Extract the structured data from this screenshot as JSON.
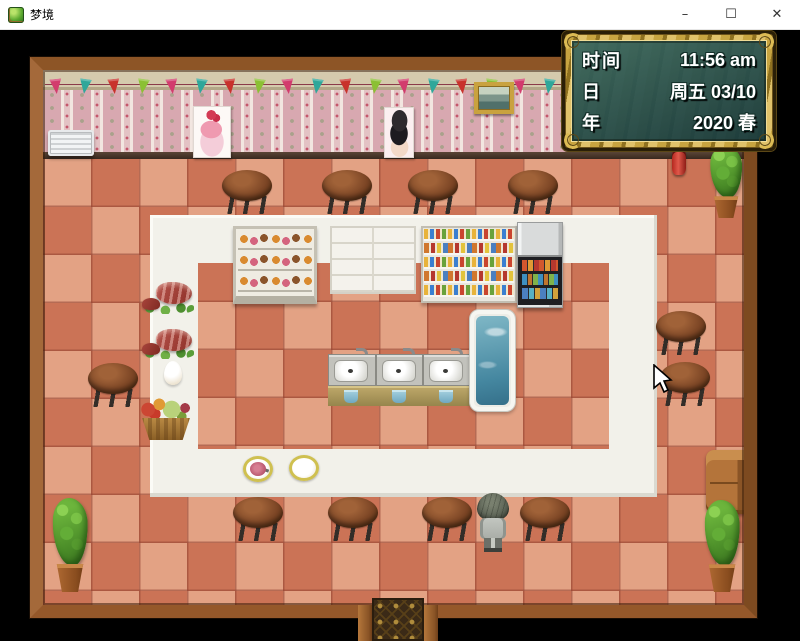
{
  "window": {
    "title": "梦境",
    "controls": {
      "minimize": "–",
      "maximize": "☐",
      "close": "✕"
    }
  },
  "hud": {
    "rows": [
      {
        "label": "时间",
        "value": "11:56 am"
      },
      {
        "label": "日",
        "value": "周五 03/10"
      },
      {
        "label": "年",
        "value": "2020 春"
      }
    ],
    "colors": {
      "frame_gold": "#c7a440",
      "panel_teal": "rgba(34,72,72,0.94)",
      "text": "#ffffff"
    }
  },
  "scene": {
    "colors": {
      "floor_tile_light": "#e3a284",
      "floor_tile_dark": "#cb7356",
      "island_white": "#f2f1ea",
      "wood_frame": "#9a5d2b",
      "wallpaper_pink": "#d8a8b0"
    },
    "flag_colors": [
      "#d23c6d",
      "#2fa79a",
      "#c8322b",
      "#8bc034"
    ],
    "flags": {
      "count": 24,
      "start_x": 50,
      "step": 29,
      "y": 49
    },
    "stools": [
      {
        "x": 221,
        "y": 140
      },
      {
        "x": 321,
        "y": 140
      },
      {
        "x": 407,
        "y": 140
      },
      {
        "x": 507,
        "y": 140
      },
      {
        "x": 655,
        "y": 281
      },
      {
        "x": 659,
        "y": 332
      },
      {
        "x": 87,
        "y": 333
      },
      {
        "x": 232,
        "y": 467
      },
      {
        "x": 327,
        "y": 467
      },
      {
        "x": 421,
        "y": 467
      },
      {
        "x": 519,
        "y": 467
      }
    ],
    "plants": [
      {
        "name": "potted-plant-top-right",
        "x": 704,
        "y": 116,
        "w": 44,
        "h": 72
      },
      {
        "name": "potted-plant-bottom-left",
        "x": 46,
        "y": 468,
        "w": 48,
        "h": 94
      },
      {
        "name": "potted-plant-bottom-right",
        "x": 698,
        "y": 470,
        "w": 48,
        "h": 92
      }
    ]
  }
}
